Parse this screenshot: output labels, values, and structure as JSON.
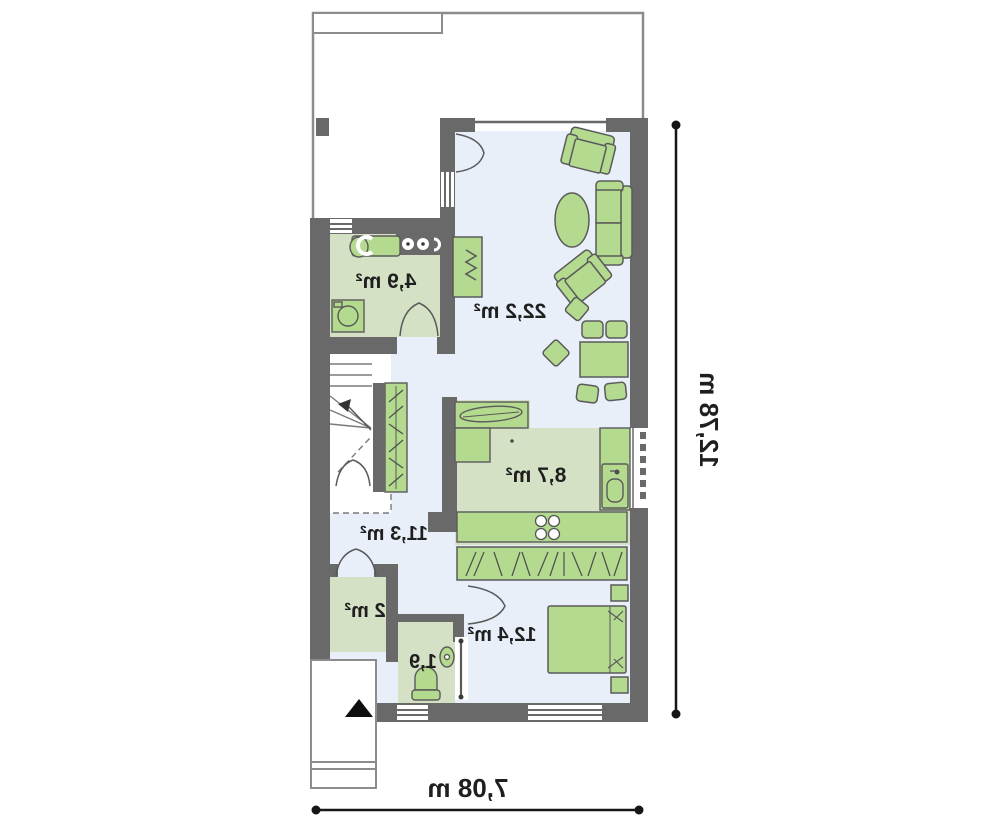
{
  "plan": {
    "title": "ground-floor-plan-mirrored",
    "rooms": [
      {
        "name": "utility-bathroom",
        "label": "4,9 m²"
      },
      {
        "name": "living-room",
        "label": "22,2 m²"
      },
      {
        "name": "kitchen",
        "label": "8,7 m²"
      },
      {
        "name": "hallway",
        "label": "11,3 m²"
      },
      {
        "name": "closet",
        "label": "2 m²"
      },
      {
        "name": "wc",
        "label": "1,9"
      },
      {
        "name": "bedroom",
        "label": "12,4 m²"
      }
    ],
    "dimensions": {
      "width_label": "7,08 m",
      "height_label": "12,78 m"
    },
    "symbols": [
      "stairs",
      "wardrobe",
      "fireplace",
      "armchair",
      "sofa",
      "coffee-table",
      "dining-table",
      "dining-chair",
      "kitchen-worktop",
      "kitchen-sink",
      "fridge",
      "cooktop-burners",
      "bed",
      "nightstand",
      "toilet",
      "washbasin",
      "washing-machine",
      "sliding-door",
      "door-swing",
      "entrance-arrow",
      "window",
      "chimney",
      "radiator"
    ],
    "colors": {
      "wall": "#696969",
      "thin_outline": "#8c8c8c",
      "floor_blue": "#e9eff9",
      "floor_green": "#d5e1c5",
      "furniture_green": "#b3da8f",
      "text": "#1f1f1f",
      "arrow": "#0d0d0d"
    }
  }
}
